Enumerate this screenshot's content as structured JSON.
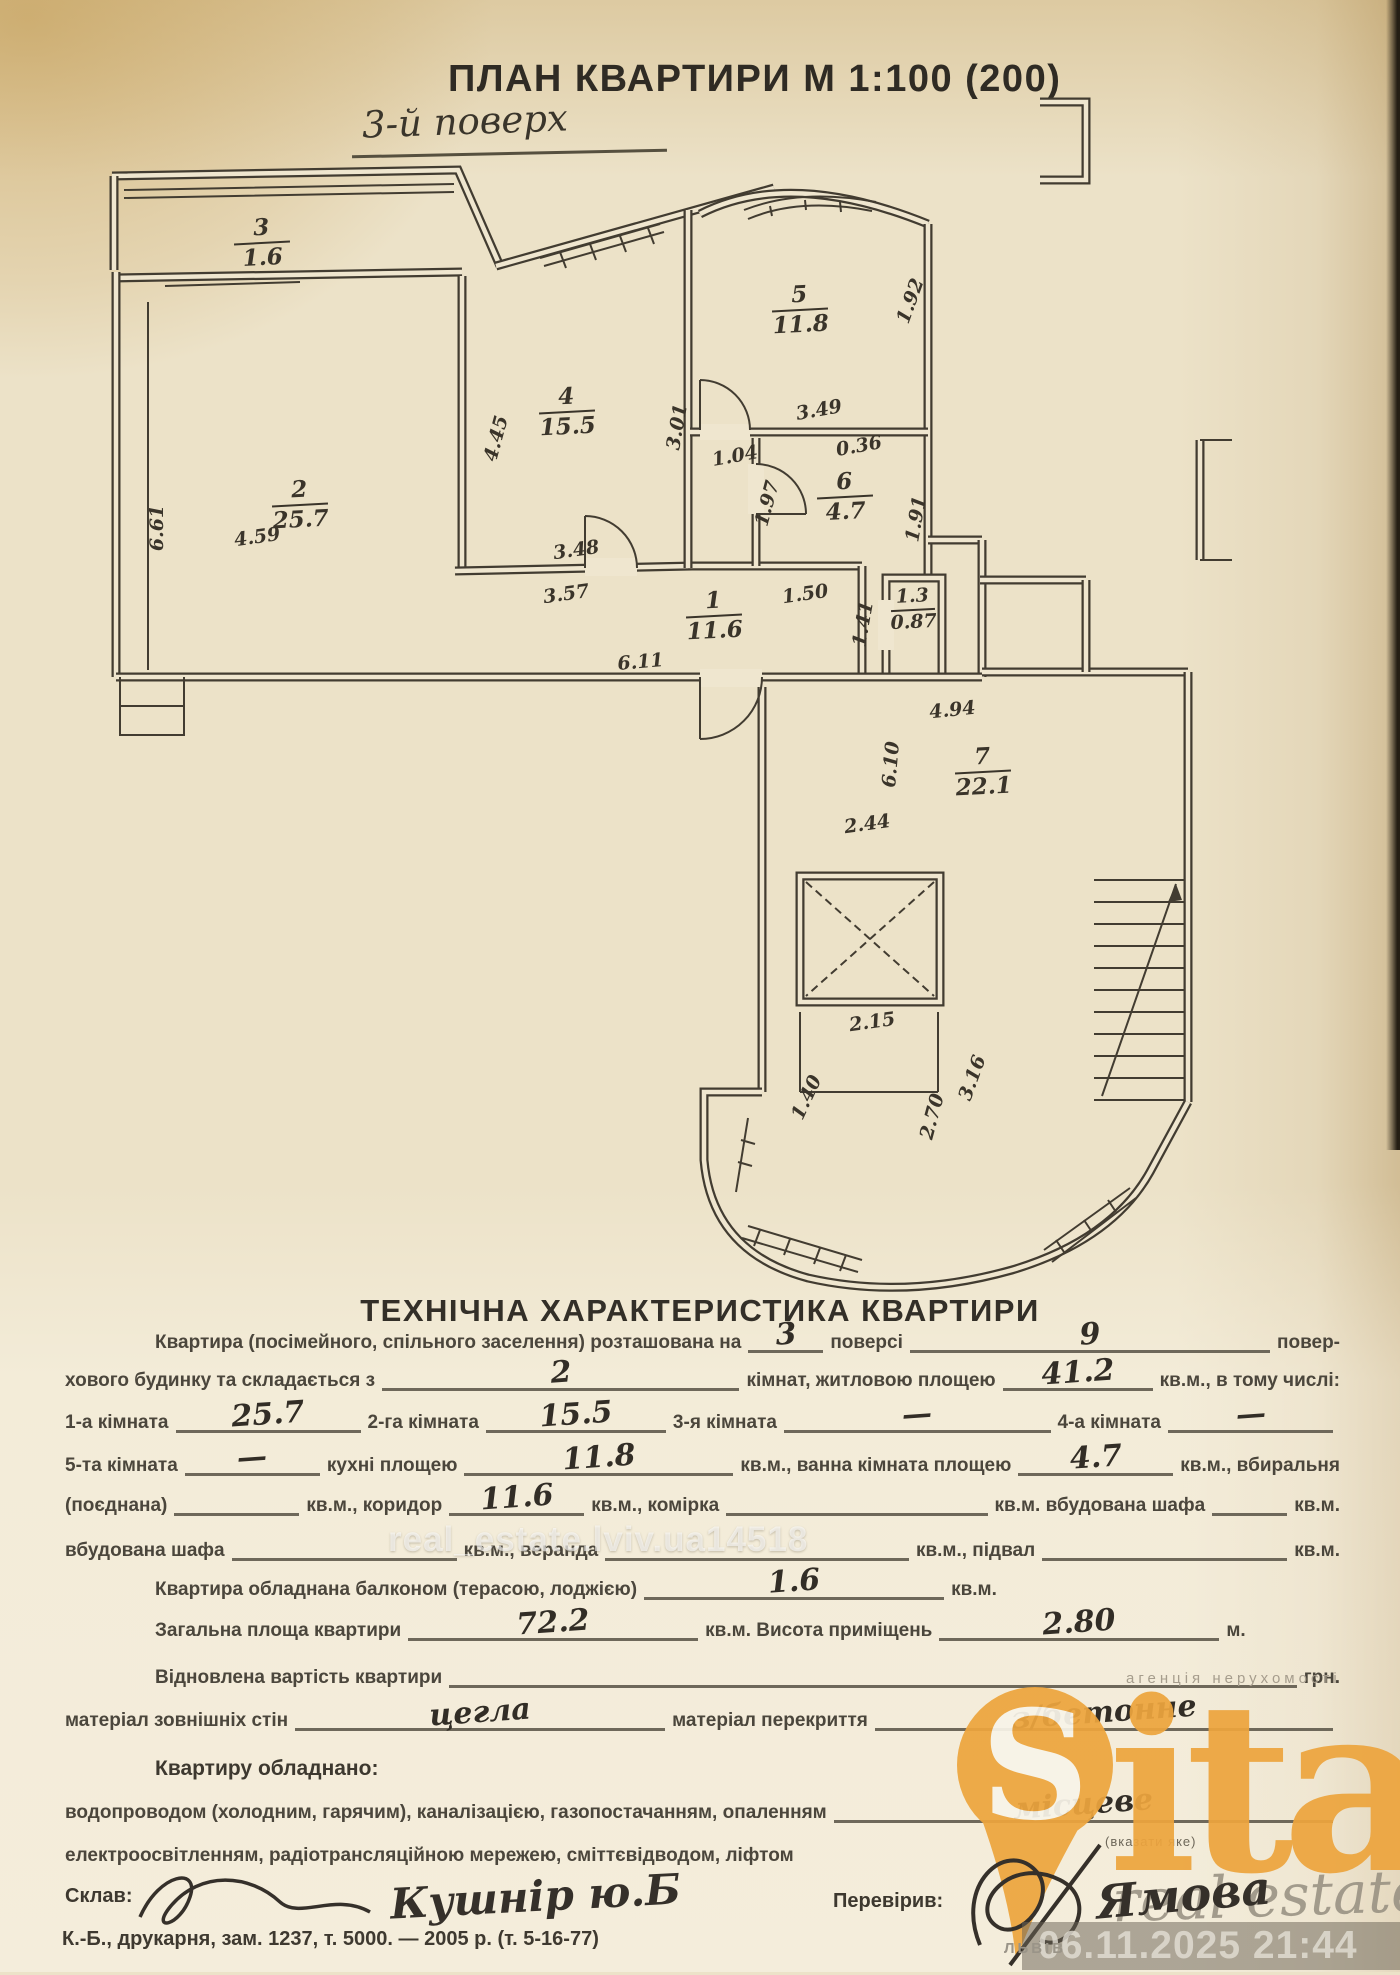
{
  "header": {
    "title": "ПЛАН КВАРТИРИ М 1:100 (200)",
    "floor_note": "3-й поверх"
  },
  "plan": {
    "room_labels": [
      {
        "x": 262,
        "y": 243,
        "num": "3",
        "area": "1.6"
      },
      {
        "x": 300,
        "y": 505,
        "num": "2",
        "area": "25.7"
      },
      {
        "x": 567,
        "y": 412,
        "num": "4",
        "area": "15.5"
      },
      {
        "x": 800,
        "y": 310,
        "num": "5",
        "area": "11.8"
      },
      {
        "x": 845,
        "y": 497,
        "num": "6",
        "area": "4.7"
      },
      {
        "x": 714,
        "y": 616,
        "num": "1",
        "area": "11.6"
      },
      {
        "x": 913,
        "y": 610,
        "num": "1.3",
        "area": "0.87",
        "small": true
      },
      {
        "x": 983,
        "y": 772,
        "num": "7",
        "area": "22.1"
      }
    ],
    "dim_labels": [
      {
        "x": 163,
        "y": 528,
        "t": "6.61",
        "r": -90
      },
      {
        "x": 258,
        "y": 543,
        "t": "4.59",
        "r": -8
      },
      {
        "x": 502,
        "y": 440,
        "t": "4.45",
        "r": -75
      },
      {
        "x": 577,
        "y": 556,
        "t": "3.48",
        "r": -8
      },
      {
        "x": 567,
        "y": 600,
        "t": "3.57",
        "r": -8
      },
      {
        "x": 683,
        "y": 428,
        "t": "3.01",
        "r": -80
      },
      {
        "x": 736,
        "y": 462,
        "t": "1.04",
        "r": -10
      },
      {
        "x": 773,
        "y": 505,
        "t": "1.97",
        "r": -75
      },
      {
        "x": 820,
        "y": 416,
        "t": "3.49",
        "r": -10
      },
      {
        "x": 860,
        "y": 452,
        "t": "0.36",
        "r": -10
      },
      {
        "x": 916,
        "y": 303,
        "t": "1.92",
        "r": -70
      },
      {
        "x": 922,
        "y": 520,
        "t": "1.91",
        "r": -80
      },
      {
        "x": 641,
        "y": 668,
        "t": "6.11",
        "r": -5
      },
      {
        "x": 806,
        "y": 600,
        "t": "1.50",
        "r": -8
      },
      {
        "x": 869,
        "y": 625,
        "t": "1.41",
        "r": -80
      },
      {
        "x": 953,
        "y": 716,
        "t": "4.94",
        "r": -6
      },
      {
        "x": 868,
        "y": 830,
        "t": "2.44",
        "r": -8
      },
      {
        "x": 897,
        "y": 765,
        "t": "6.10",
        "r": -85
      },
      {
        "x": 873,
        "y": 1028,
        "t": "2.15",
        "r": -8
      },
      {
        "x": 812,
        "y": 1100,
        "t": "1.40",
        "r": -65
      },
      {
        "x": 938,
        "y": 1118,
        "t": "2.70",
        "r": -75
      },
      {
        "x": 978,
        "y": 1080,
        "t": "3.16",
        "r": -70
      }
    ]
  },
  "tech": {
    "heading": "ТЕХНІЧНА ХАРАКТЕРИСТИКА КВАРТИРИ",
    "lines": [
      {
        "top": 1332,
        "indent": 155,
        "justify": true,
        "seg": [
          {
            "t": "Квартира (посімейного, спільного заселення) розташована на"
          },
          {
            "v": "3",
            "w": 75
          },
          {
            "t": "поверсі"
          },
          {
            "v": "9",
            "w": 260,
            "g": 1
          },
          {
            "t": "повер-"
          }
        ]
      },
      {
        "top": 1370,
        "indent": 65,
        "justify": true,
        "seg": [
          {
            "t": "хового будинку та складається з"
          },
          {
            "v": "2",
            "w": 240,
            "g": 1
          },
          {
            "t": "кімнат, житловою площею"
          },
          {
            "v": "41.2",
            "w": 150
          },
          {
            "t": "кв.м., в тому числі:"
          }
        ]
      },
      {
        "top": 1412,
        "indent": 65,
        "justify": true,
        "seg": [
          {
            "t": "1-а кімната"
          },
          {
            "v": "25.7",
            "w": 185
          },
          {
            "t": "2-га кімната"
          },
          {
            "v": "15.5",
            "w": 180
          },
          {
            "t": "3-я кімната"
          },
          {
            "v": "—",
            "w": 185,
            "g": 1
          },
          {
            "t": "4-а кімната"
          },
          {
            "v": "—",
            "w": 165
          }
        ]
      },
      {
        "top": 1455,
        "indent": 65,
        "justify": true,
        "seg": [
          {
            "t": "5-та кімната"
          },
          {
            "v": "—",
            "w": 135
          },
          {
            "t": "кухні площею"
          },
          {
            "v": "11.8",
            "w": 165,
            "g": 1
          },
          {
            "t": "кв.м., ванна кімната площею"
          },
          {
            "v": "4.7",
            "w": 155
          },
          {
            "t": "кв.м., вбиральня"
          }
        ]
      },
      {
        "top": 1495,
        "indent": 65,
        "justify": true,
        "seg": [
          {
            "t": "(поєднана)"
          },
          {
            "v": "",
            "w": 125
          },
          {
            "t": "кв.м., коридор"
          },
          {
            "v": "11.6",
            "w": 135
          },
          {
            "t": "кв.м., комірка"
          },
          {
            "v": "",
            "w": 150,
            "g": 1
          },
          {
            "t": "кв.м. вбудована шафа"
          },
          {
            "v": "",
            "w": 75
          },
          {
            "t": "кв.м."
          }
        ]
      },
      {
        "top": 1540,
        "indent": 65,
        "justify": true,
        "seg": [
          {
            "t": "вбудована шафа"
          },
          {
            "v": "",
            "w": 225
          },
          {
            "t": "кв.м., веранда"
          },
          {
            "v": "",
            "w": 225,
            "g": 1
          },
          {
            "t": "кв.м., підвал"
          },
          {
            "v": "",
            "w": 245
          },
          {
            "t": "кв.м."
          }
        ]
      },
      {
        "top": 1579,
        "indent": 155,
        "seg": [
          {
            "t": "Квартира обладнана балконом (терасою, лоджією)"
          },
          {
            "v": "1.6",
            "w": 300
          },
          {
            "t": "кв.м."
          }
        ]
      },
      {
        "top": 1620,
        "indent": 155,
        "seg": [
          {
            "t": "Загальна площа квартири"
          },
          {
            "v": "72.2",
            "w": 290
          },
          {
            "t": "кв.м. Висота приміщень"
          },
          {
            "v": "2.80",
            "w": 280
          },
          {
            "t": "м."
          }
        ]
      },
      {
        "top": 1667,
        "indent": 155,
        "justify": true,
        "seg": [
          {
            "t": "Відновлена вартість квартири"
          },
          {
            "v": "",
            "w": 560,
            "g": 1
          },
          {
            "t": "грн."
          }
        ]
      },
      {
        "top": 1710,
        "indent": 65,
        "justify": true,
        "seg": [
          {
            "t": "матеріал зовнішніх стін"
          },
          {
            "v": "цегла",
            "w": 370
          },
          {
            "t": "матеріал перекриття"
          },
          {
            "v": "з/бетонне",
            "w": 370,
            "g": 1
          }
        ]
      },
      {
        "top": 1757,
        "indent": 155,
        "bold": true,
        "seg": [
          {
            "t": "Квартиру обладнано:"
          }
        ]
      },
      {
        "top": 1802,
        "indent": 65,
        "justify": true,
        "seg": [
          {
            "t": "водопроводом (холодним, гарячим), каналізацією, газопостачанням, опаленням"
          },
          {
            "v": "місцеве",
            "w": 240,
            "g": 1
          }
        ]
      },
      {
        "top": 1845,
        "indent": 65,
        "seg": [
          {
            "t": "електроосвітленням, радіотрансляційною мережею, сміттєвідводом, ліфтом"
          }
        ]
      }
    ],
    "note_under_blank": "(вказати яке)",
    "composer_label": "Склав:",
    "composer_signature": "Кушнір ю.Б",
    "checker_label": "Перевірив:",
    "checker_signature": "Ямова",
    "print_footer": "К.-Б., друкарня, зам. 1237, т. 5000. — 2005 р. (т. 5-16-77)"
  },
  "watermarks": {
    "center_text": "real_estate.lviv.ua14518",
    "agency_tagline": "агенція нерухомості",
    "logo_letter": "S",
    "logo_text": "italo",
    "logo_color": "#eda53e",
    "script_text": "real estate",
    "city": "ЛЬВІВ",
    "timestamp": "06.11.2025 21:44"
  }
}
